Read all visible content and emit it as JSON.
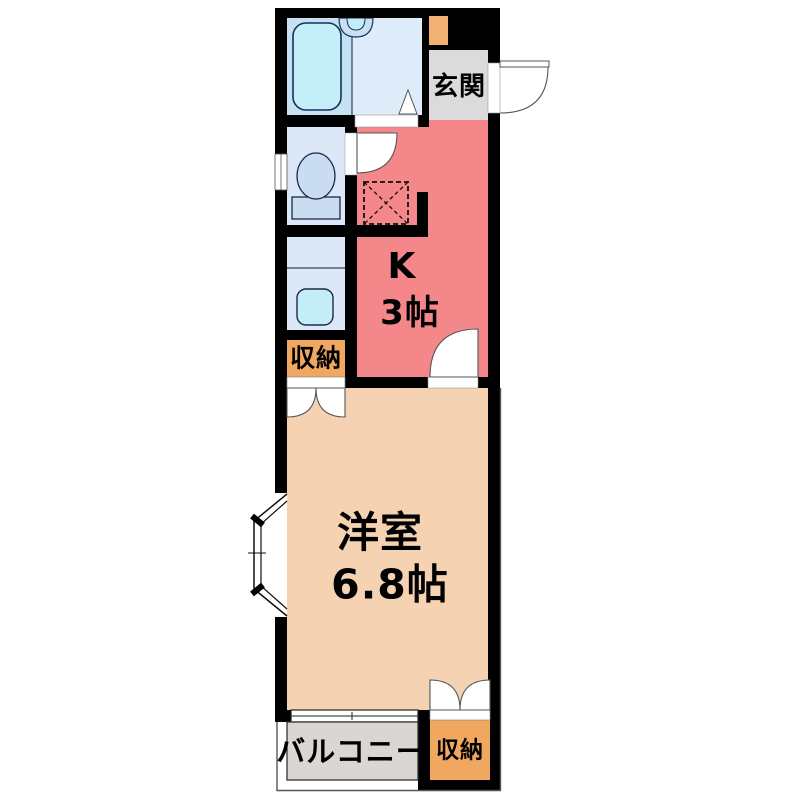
{
  "plan": {
    "type": "apartment-floor-plan",
    "rooms": {
      "entrance": {
        "label": "玄関"
      },
      "kitchen": {
        "label": "K",
        "size": "3帖"
      },
      "storage_upper": {
        "label": "収納"
      },
      "western_room": {
        "label": "洋室",
        "size": "6.8帖"
      },
      "balcony": {
        "label": "バルコニー"
      },
      "storage_lower": {
        "label": "収納"
      }
    },
    "fixtures": [
      "bathtub",
      "bath-washbasin",
      "toilet",
      "vanity-basin",
      "appliance-space",
      "bay-window",
      "sliding-window",
      "entrance-door",
      "hinged-door",
      "double-doors",
      "small-window"
    ],
    "colors": {
      "wall": "#000000",
      "kitchen": "#F48789",
      "western_room": "#F5D3B2",
      "storage": "#F0A75F",
      "shoe_cabinet": "#F2B173",
      "entrance_floor": "#DBDBDB",
      "balcony_floor": "#DAD6D3",
      "bath_floor": "#DEEBF9",
      "bath_tub_zone": "#C6E1F3",
      "sanitary_floor": "#DCE8F8",
      "fixture_blue": "#C9DCF2",
      "water_cyan": "#C3EEF7",
      "door_white": "#FFFFFF"
    }
  }
}
